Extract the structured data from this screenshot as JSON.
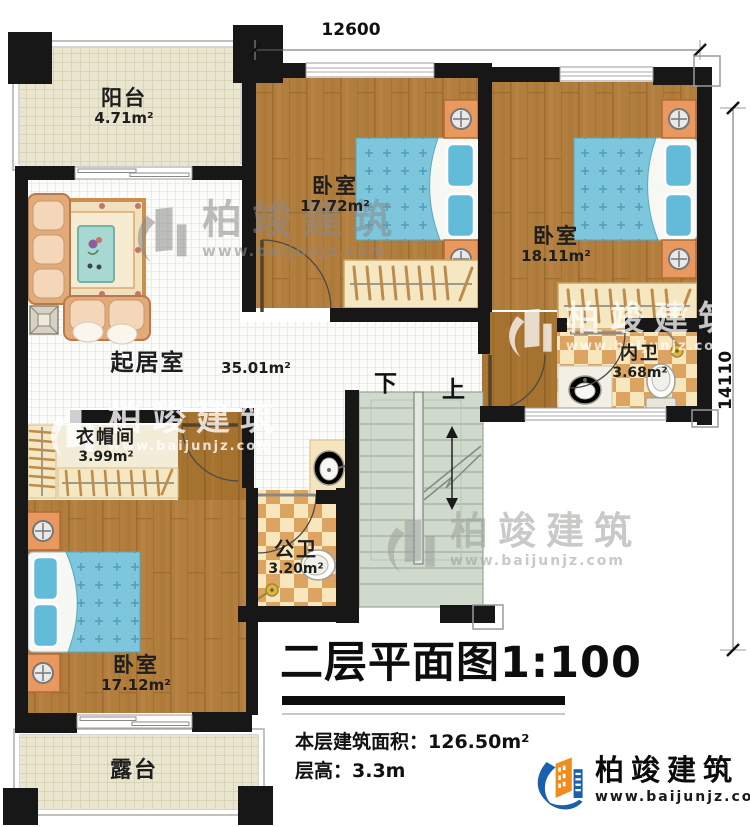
{
  "dimensions": {
    "top": "12600",
    "right": "14110"
  },
  "rooms": {
    "balcony": {
      "name": "阳台",
      "area": "4.71m²"
    },
    "bedroom_top": {
      "name": "卧室",
      "area": "17.72m²"
    },
    "bedroom_right": {
      "name": "卧室",
      "area": "18.11m²"
    },
    "inner_bath": {
      "name": "内卫",
      "area": "3.68m²"
    },
    "living_room": {
      "name": "起居室",
      "area": "35.01m²"
    },
    "cloakroom": {
      "name": "衣帽间",
      "area": "3.99m²"
    },
    "public_bath": {
      "name": "公卫",
      "area": "3.20m²"
    },
    "bedroom_bottom": {
      "name": "卧室",
      "area": "17.12m²"
    },
    "terrace": {
      "name": "露台"
    }
  },
  "stairs": {
    "down_label": "下",
    "up_label": "上"
  },
  "title_block": {
    "title": "二层平面图1:100",
    "area_label": "本层建筑面积：",
    "area_value": "126.50m²",
    "floor_height_label": "层高：",
    "floor_height_value": "3.3m"
  },
  "logo": {
    "company": "柏竣建筑",
    "website": "www.baijunjz.com"
  },
  "watermark": {
    "company": "柏竣建筑",
    "website": "www.baijunjz.com"
  },
  "colors": {
    "wall": "#171717",
    "wood": "#b27e3d",
    "bed": "#7ec6db",
    "checker_tan": "#dda461",
    "checker_cream": "#f8e7bd",
    "balcony_floor": "#eae5cf",
    "stairs": "#cfd9cc",
    "nightstand": "#e9995d",
    "logo_blue": "#1961ac",
    "logo_orange": "#f08c1e"
  }
}
